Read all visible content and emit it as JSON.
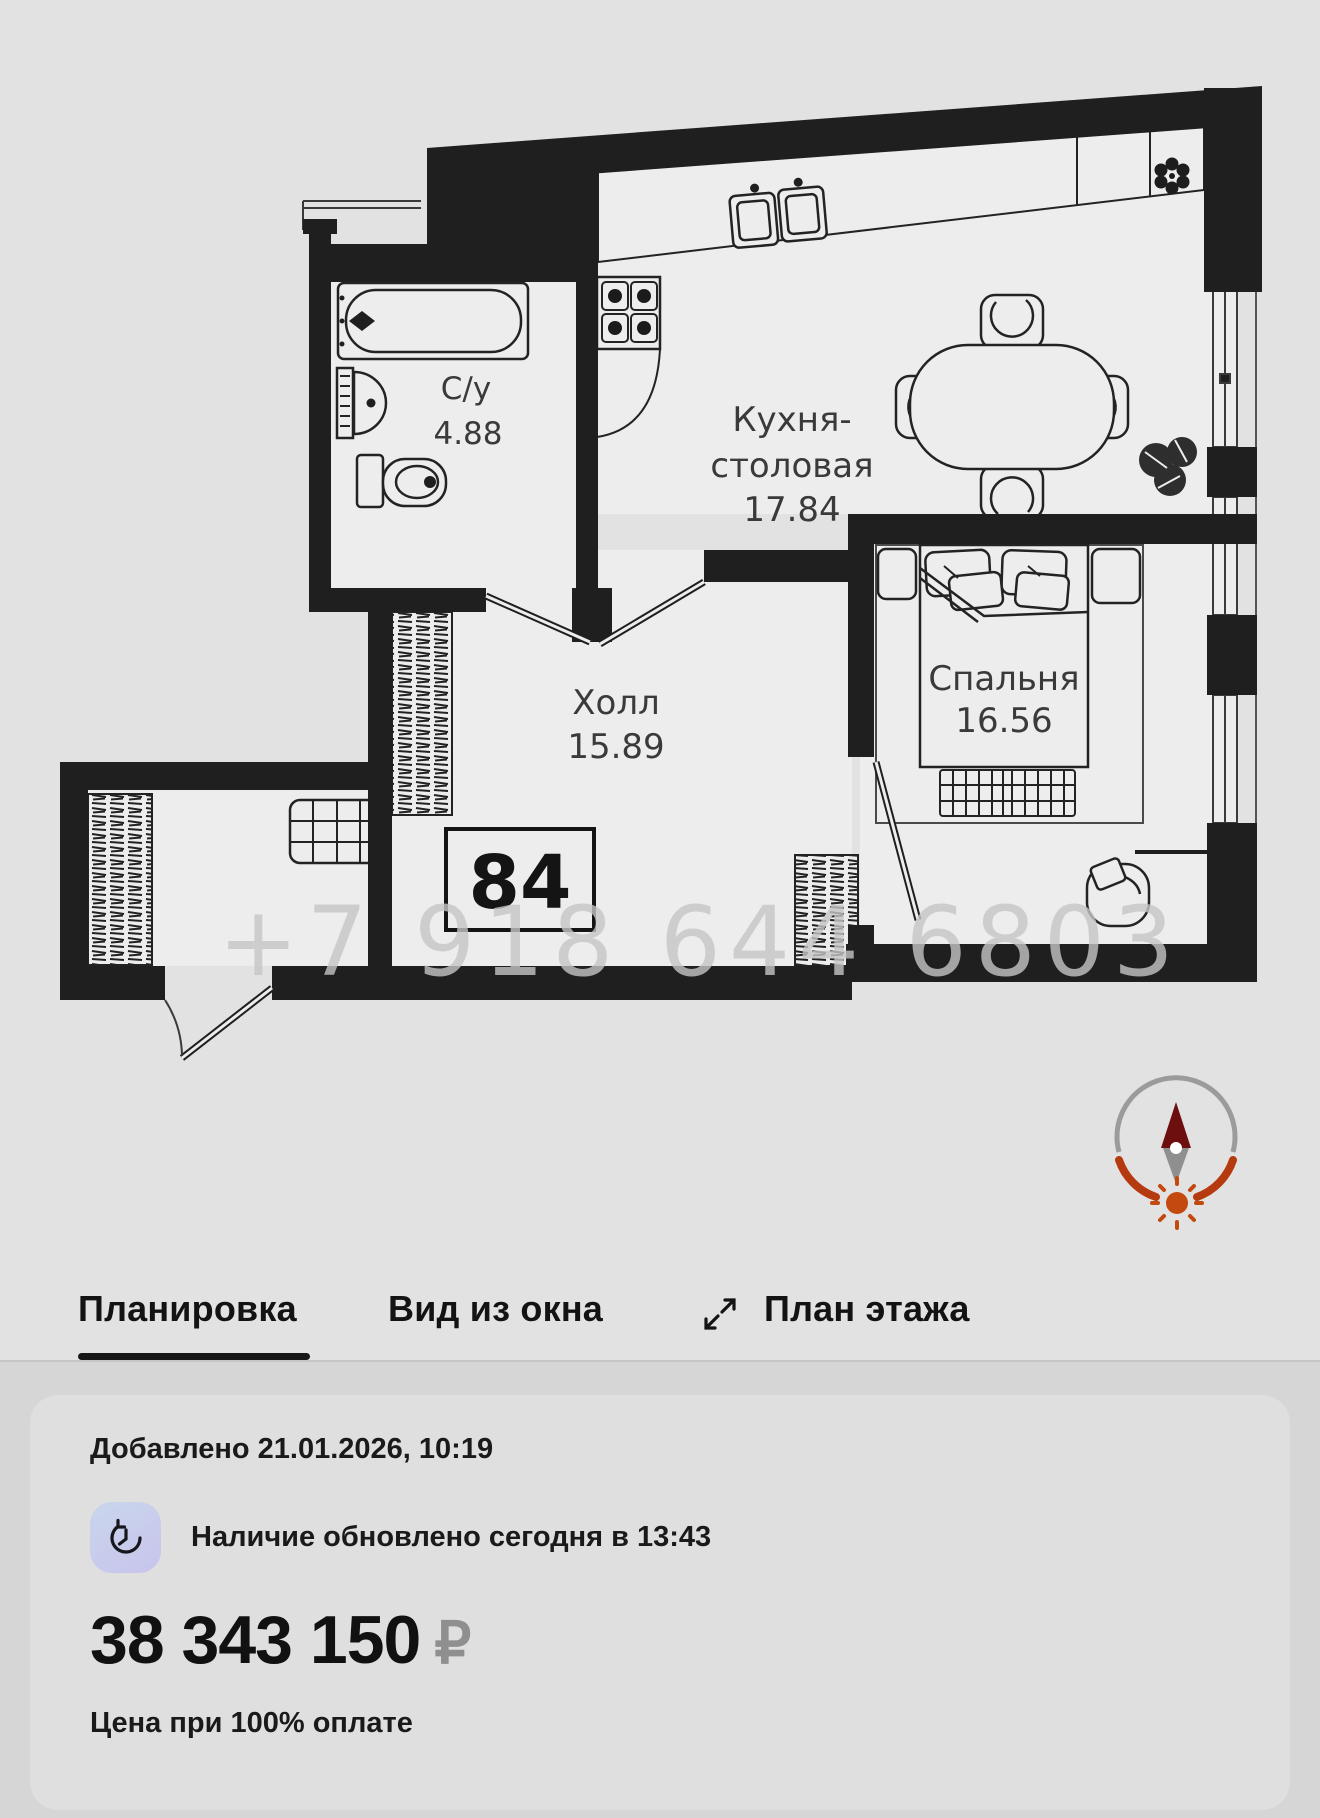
{
  "colors": {
    "watermark": "#c6c6c6",
    "compass_arc_gray": "#9b9b9b",
    "compass_arc_red": "#b63a10",
    "compass_needle_red": "#6d0f0f",
    "compass_needle_gray": "#8f8f8f",
    "compass_sun": "#c3490f"
  },
  "floor_plan": {
    "apartment_number": "84",
    "watermark_phone": "+7 918 644 6803",
    "rooms": {
      "bathroom": {
        "label": "С/у",
        "area": "4.88"
      },
      "kitchen": {
        "label_line1": "Кухня-",
        "label_line2": "столовая",
        "area": "17.84"
      },
      "hall": {
        "label": "Холл",
        "area": "15.89"
      },
      "bedroom": {
        "label": "Спальня",
        "area": "16.56"
      }
    }
  },
  "tabs": {
    "layout": "Планировка",
    "window_view": "Вид из окна",
    "floor_plan": "План этажа"
  },
  "listing": {
    "added": "Добавлено 21.01.2026, 10:19",
    "availability": "Наличие обновлено сегодня в 13:43",
    "price": "38 343 150",
    "currency": "₽",
    "price_note": "Цена при 100% оплате"
  }
}
